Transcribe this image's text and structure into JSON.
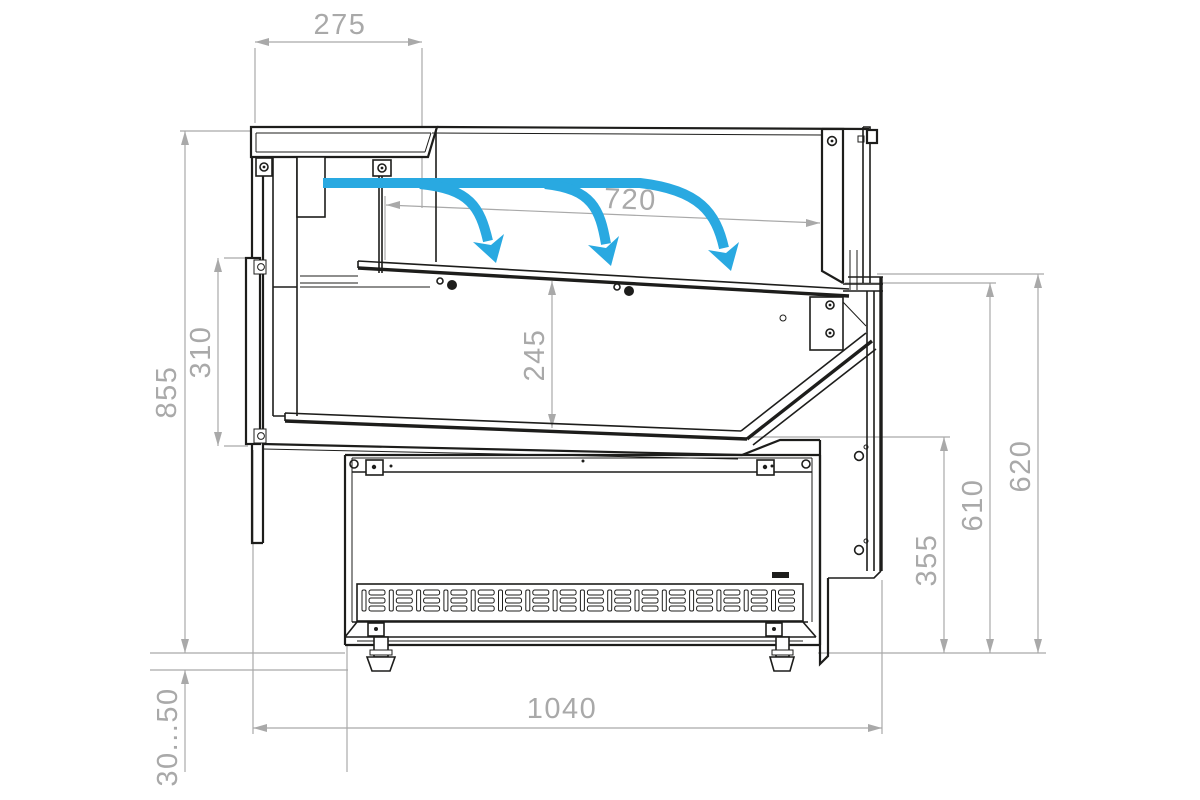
{
  "drawing": {
    "colors": {
      "line": "#1d1d1b",
      "dimension": "#a9a9a9",
      "airflow": "#29a9e1",
      "background": "#ffffff"
    },
    "airflow": {
      "arrow_count": 3
    }
  },
  "dimensions": {
    "canopy_width": {
      "label": "275"
    },
    "display_opening": {
      "label": "720"
    },
    "overall_height": {
      "label": "855"
    },
    "rear_door_height": {
      "label": "310"
    },
    "well_depth": {
      "label": "245"
    },
    "front_height_outer": {
      "label": "620"
    },
    "front_height_inner": {
      "label": "610"
    },
    "base_front_height": {
      "label": "355"
    },
    "overall_depth": {
      "label": "1040"
    },
    "leg_adjustment": {
      "label": "30...50"
    }
  }
}
